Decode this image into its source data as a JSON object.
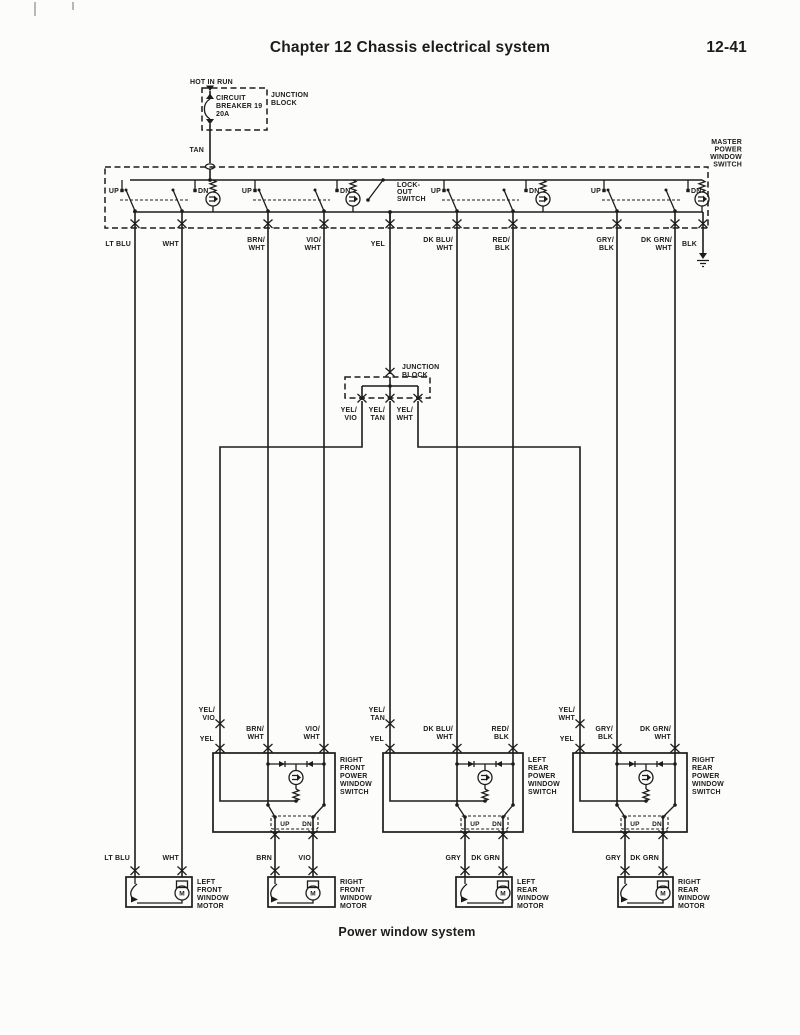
{
  "page": {
    "header": "Chapter 12 Chassis electrical system",
    "page_number": "12-41",
    "caption": "Power window system"
  },
  "colors": {
    "ink": "#1c1c1c",
    "paper": "#fcfcfb"
  },
  "t": {
    "hot_in_run": "HOT IN RUN",
    "junction": "JUNCTION",
    "block": "BLOCK",
    "circuit": "CIRCUIT",
    "breaker": "BREAKER 19",
    "amps": "20A",
    "tan": "TAN",
    "master": "MASTER",
    "power": "POWER",
    "window": "WINDOW",
    "switch": "SWITCH",
    "motor": "MOTOR",
    "left": "LEFT",
    "right": "RIGHT",
    "front": "FRONT",
    "rear": "REAR",
    "up": "UP",
    "dn": "DN",
    "lock": "LOCK-",
    "out": "OUT",
    "m": "M",
    "lt_blu": "LT BLU",
    "wht": "WHT",
    "yel": "YEL",
    "blk": "BLK",
    "brn": "BRN",
    "vio": "VIO",
    "gry": "GRY",
    "dk_grn": "DK GRN",
    "yel_sl": "YEL/",
    "brn_sl": "BRN/",
    "vio_sl": "VIO/",
    "dk_blu_sl": "DK BLU/",
    "red_sl": "RED/",
    "gry_sl": "GRY/",
    "dk_grn_sl": "DK GRN/"
  }
}
